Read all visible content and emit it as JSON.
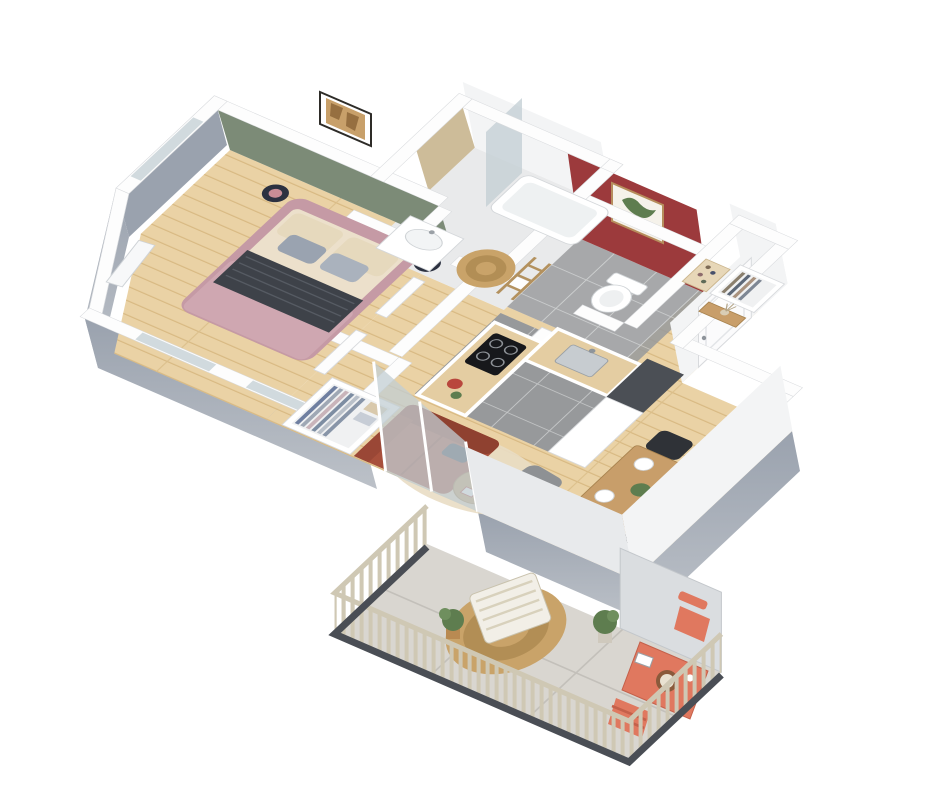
{
  "figure": {
    "type": "3d-isometric-floor-plan",
    "description": "Top-down 3D rendering of a one-bedroom apartment with balcony",
    "label": "3D apartment floor plan"
  },
  "palette": {
    "wall_top": "#fdfdfd",
    "wall_edge": "#d8dadd",
    "wall_face": "#f3f4f5",
    "outer_gray_1": "#9aa2ae",
    "outer_gray_2": "#bcc1c8",
    "green_wall": "#7c8b77",
    "red_wall": "#9c3a3c",
    "tan_wall": "#cdbc99",
    "wood_light": "#ead2a5",
    "wood_line": "#d8b982",
    "tile_gray": "#97999b",
    "bath_floor": "#e9eaeb",
    "balcony_tile": "#d9d6d0",
    "glass": "#c2ced3",
    "sofa": "#a8503c",
    "bed_frame": "#c59aa5",
    "bed_duvet": "#cfa7b1",
    "blanket": "#3e4249",
    "sheet": "#ece0cb",
    "rug_beige": "#e9ddc4",
    "jute": "#c9a369",
    "pouf": "#8e9194",
    "chair_dark": "#2f3237",
    "table_wood": "#c89e6a",
    "coral": "#e0785f",
    "plant": "#5e7d4f",
    "fridge": "#4b4f55",
    "rail_wood": "#cfc8b4",
    "rail_base": "#4a4e55"
  },
  "rooms": {
    "bedroom": {
      "label": "Bedroom",
      "accent_wall": "sage green",
      "items": [
        "double-bed",
        "dark-throw-blanket",
        "pillows",
        "nightstand-lamps",
        "framed-art",
        "window",
        "leaning-mirror",
        "open-wardrobe"
      ]
    },
    "bathroom": {
      "label": "Bathroom",
      "accent_wall": "tan",
      "items": [
        "bathtub-shower",
        "glass-screen",
        "sink-vanity",
        "ladder-towel-rack",
        "round-jute-rug"
      ]
    },
    "wc": {
      "label": "WC",
      "accent_wall": "brick red",
      "items": [
        "toilet",
        "botanical-framed-art"
      ]
    },
    "entry": {
      "label": "Entry hall",
      "items": [
        "front-door",
        "console-table",
        "wardrobe-closet",
        "shoe-shelf"
      ]
    },
    "kitchen": {
      "label": "Kitchen",
      "items": [
        "island-counter",
        "induction-hob",
        "sink",
        "fridge-column",
        "tall-cabinet",
        "gray-tile-floor"
      ]
    },
    "living": {
      "label": "Living room",
      "items": [
        "terracotta-sofa",
        "round-coffee-table",
        "gray-pouf",
        "beige-rug",
        "windows",
        "sliding-glass-door"
      ]
    },
    "dining": {
      "label": "Dining area",
      "items": [
        "wooden-table",
        "four-dark-chairs",
        "place-settings",
        "plant-centerpiece"
      ]
    },
    "balcony": {
      "label": "Balcony",
      "items": [
        "wood-slat-railing",
        "privacy-screen",
        "sun-lounger",
        "round-jute-rug",
        "coral-bistro-table",
        "two-coral-chairs",
        "potted-plants",
        "stone-tile-floor"
      ]
    }
  }
}
